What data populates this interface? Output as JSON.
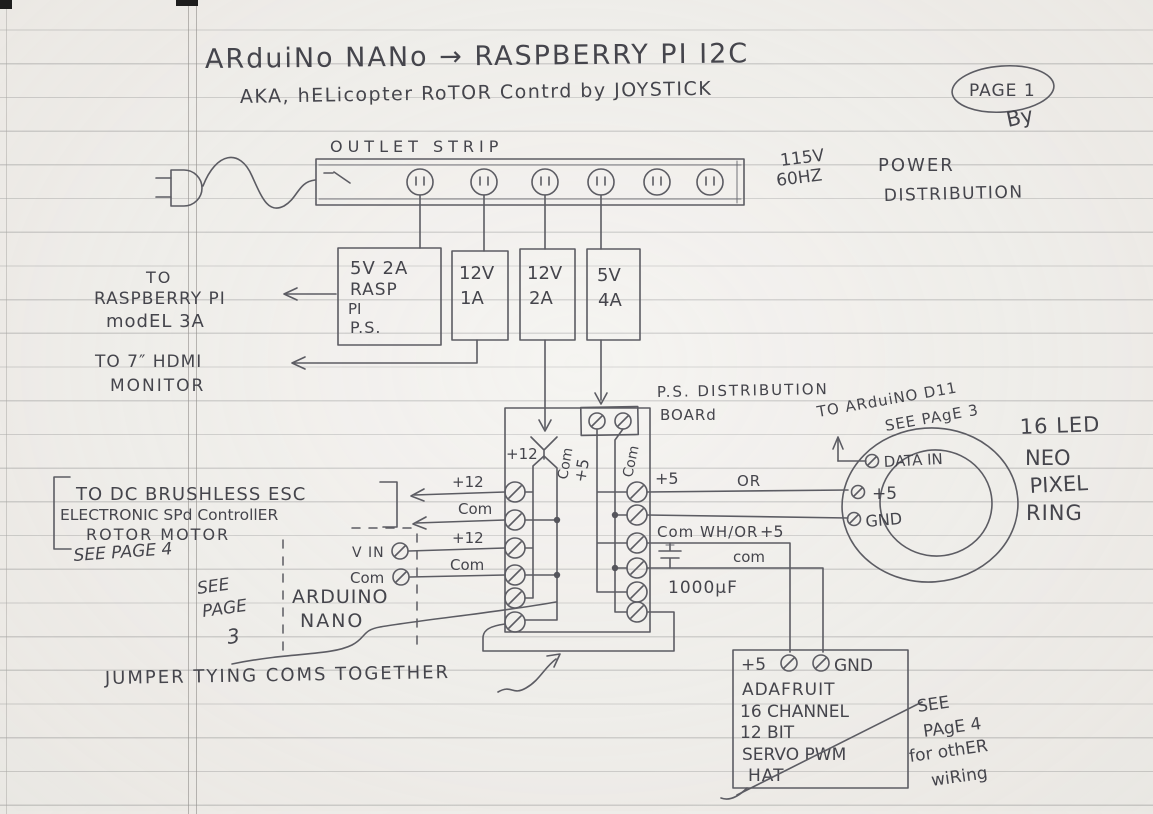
{
  "title": {
    "main": "ARduiNo NANo → RASPBERRY PI I2C",
    "sub": "AKA,  hELicopter RoTOR Contrd by JOYSTICK",
    "page_badge": "PAGE 1",
    "signature": "By"
  },
  "mains": {
    "voltage": "115V",
    "freq": "60HZ",
    "dist1": "POWER",
    "dist2": "DISTRIBUTION"
  },
  "outlet_strip": {
    "label": "OUTLET STRIP"
  },
  "supplies": {
    "ps1": [
      "5V 2A",
      "RASP",
      "PI",
      "P.S."
    ],
    "ps2": [
      "12V",
      "1A"
    ],
    "ps3": [
      "12V",
      "2A"
    ],
    "ps4": [
      "5V",
      "4A"
    ]
  },
  "destinations": {
    "rpi": [
      "TO",
      "RASPBERRY PI",
      "modEL 3A"
    ],
    "hdmi": [
      "TO 7″ HDMI",
      "MONITOR"
    ]
  },
  "board": {
    "label1": "P.S.  DISTRIBUTION",
    "label2": "BOARd",
    "plus12": "+12",
    "com_left": "Com",
    "plus5": "+5",
    "com_right": "Com"
  },
  "left_wires": {
    "w1": "+12",
    "w2": "Com",
    "w3": "+12",
    "w4": "Com"
  },
  "esc": {
    "l1": "TO DC BRUSHLESS ESC",
    "l2": "ELECTRONIC SPd ControllER",
    "l3": "ROTOR  MOTOR",
    "l4": "SEE PAGE 4"
  },
  "nano": {
    "see": "SEE",
    "page": "PAGE",
    "num": "3",
    "name1": "ARDUINO",
    "name2": "NANO",
    "vin": "V IN",
    "com": "Com"
  },
  "jumper_note": "JUMPER TYING COMS TOGETHER",
  "right_wires": {
    "w1": "+5",
    "w1b": "OR",
    "w2": "Com  WH/OR",
    "w3": "+5",
    "w4": "com",
    "cap": "1000µF"
  },
  "neopixel": {
    "note1": "TO ARduiNO D11",
    "note2": "SEE PAgE 3",
    "data_in": "DATA IN",
    "plus5": "+5",
    "gnd": "GND",
    "name": [
      "16 LED",
      "NEO",
      "PIXEL",
      "RING"
    ]
  },
  "hat": {
    "plus5": "+5",
    "gnd": "GND",
    "lines": [
      "ADAFRUIT",
      "16 CHANNEL",
      "12 BIT",
      "SERVO PWM",
      "HAT"
    ],
    "note": [
      "SEE",
      "PAgE 4",
      "for othER",
      "wiRing"
    ]
  }
}
